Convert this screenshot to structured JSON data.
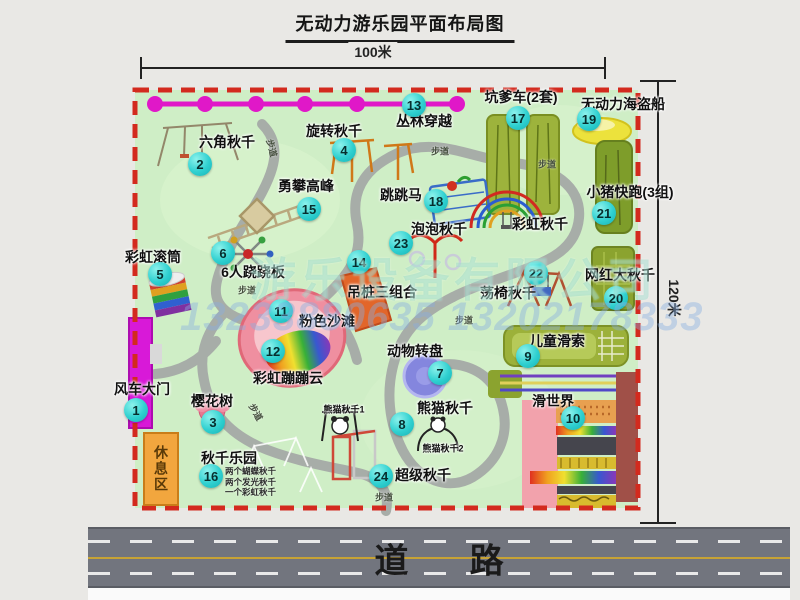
{
  "title": "无动力游乐园平面布局图",
  "dimensions": {
    "horizontal": "100米",
    "vertical": "120米"
  },
  "road_label": "道路",
  "path_label": "步道",
  "rest_area_label": "休息区",
  "watermark": {
    "company": "游乐设备有限公司",
    "phone": "13233880635 13202178333"
  },
  "attractions": [
    {
      "num": "1",
      "name": "风车大门"
    },
    {
      "num": "2",
      "name": "六角秋千"
    },
    {
      "num": "3",
      "name": "樱花树"
    },
    {
      "num": "4",
      "name": "旋转秋千"
    },
    {
      "num": "5",
      "name": "彩虹滚筒"
    },
    {
      "num": "6",
      "name": "6人跷跷板"
    },
    {
      "num": "7",
      "name": "动物转盘"
    },
    {
      "num": "8",
      "name": "熊猫秋千"
    },
    {
      "num": "9",
      "name": "儿童滑索"
    },
    {
      "num": "10",
      "name": "滑世界"
    },
    {
      "num": "11",
      "name": "粉色沙滩"
    },
    {
      "num": "12",
      "name": "彩虹蹦蹦云"
    },
    {
      "num": "13",
      "name": "丛林穿越"
    },
    {
      "num": "14",
      "name": "吊桩三组合"
    },
    {
      "num": "15",
      "name": "勇攀高峰"
    },
    {
      "num": "16",
      "name": "秋千乐园"
    },
    {
      "num": "17",
      "name": "坑爹车(2套)"
    },
    {
      "num": "18",
      "name": "跳跳马"
    },
    {
      "num": "19",
      "name": "无动力海盗船"
    },
    {
      "num": "20",
      "name": "网红大秋千"
    },
    {
      "num": "21",
      "name": "小猪快跑(3组)"
    },
    {
      "num": "22",
      "name": "荡椅秋千"
    },
    {
      "num": "23",
      "name": "泡泡秋千"
    },
    {
      "num": "24",
      "name": "超级秋千"
    }
  ],
  "annotations": {
    "rainbow_swing": "彩虹秋千",
    "panda_swing_1": "熊猫秋千1",
    "panda_swing_2": "熊猫秋千2",
    "swing_park_notes": [
      "两个蝴蝶秋千",
      "两个发光秋千",
      "一个彩虹秋千"
    ]
  },
  "colors": {
    "map_green": "#cfeec6",
    "border_red": "#d32a1e",
    "badge_cyan": "#2fd0d0",
    "gate_magenta": "#d819d8",
    "zipline_magenta": "#e018c8",
    "rest_orange": "#f2a63e",
    "road_gray": "#72757e"
  }
}
